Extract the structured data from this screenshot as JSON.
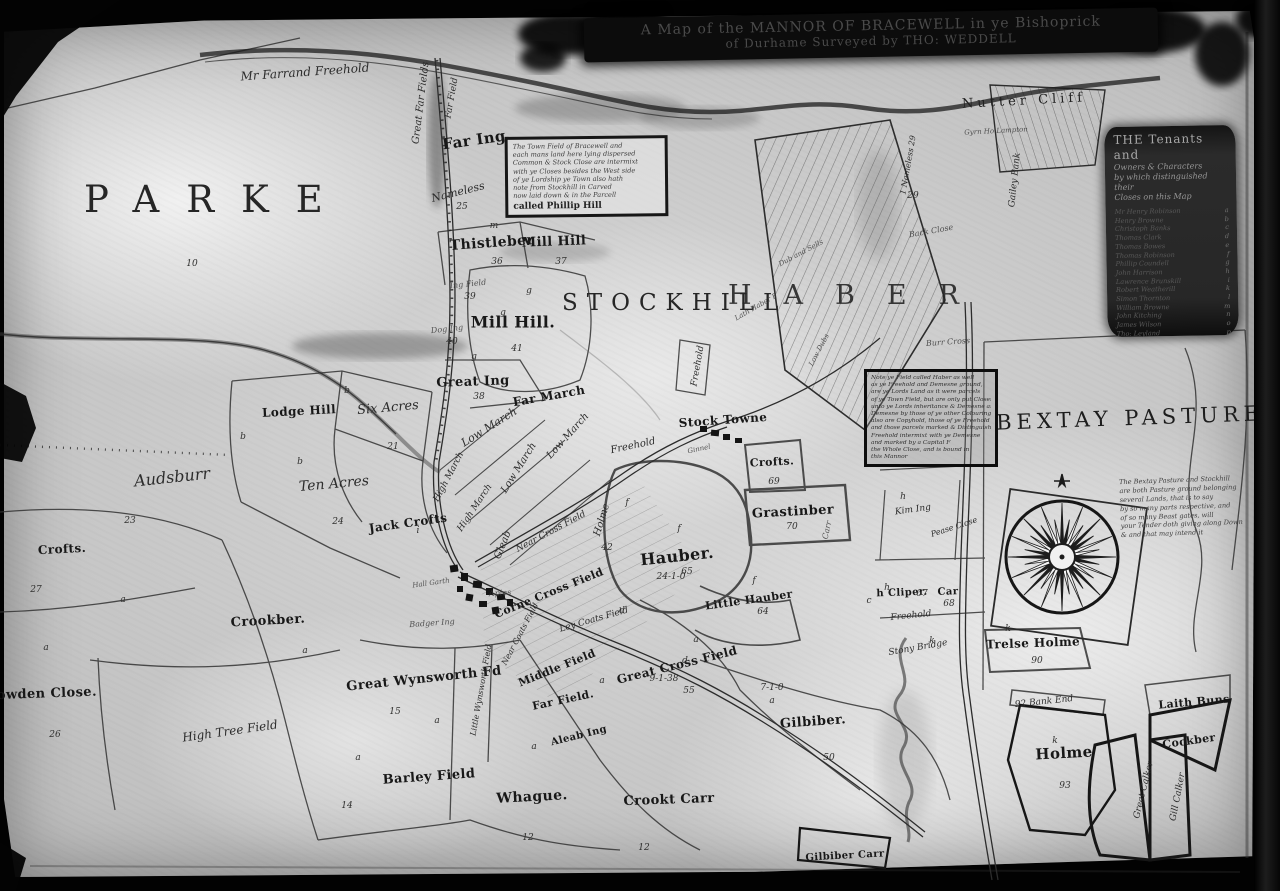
{
  "title": {
    "line1": "A Map of the MANNOR OF BRACEWELL in ye Bishoprick",
    "line2": "of Durhame Surveyed by THO: WEDDELL"
  },
  "regions": {
    "parke": "PARKE",
    "stockhill": "STOCKHILL",
    "haber": "HABER",
    "bextay": "BEXTAY PASTURE"
  },
  "legend": {
    "heading": [
      "THE Tenants and",
      "Owners & Characters",
      "by which distinguished their",
      "Closes on this Map"
    ],
    "tenants": [
      {
        "name": "Mr Henry Robinson",
        "mark": "a"
      },
      {
        "name": "Henry Browne",
        "mark": "b"
      },
      {
        "name": "Christoph Banks",
        "mark": "c"
      },
      {
        "name": "Thomas Clark",
        "mark": "d"
      },
      {
        "name": "Thomas Bowes",
        "mark": "e"
      },
      {
        "name": "Thomas Robinson",
        "mark": "f"
      },
      {
        "name": "Phillip Coundell",
        "mark": "g"
      },
      {
        "name": "John Harrison",
        "mark": "h"
      },
      {
        "name": "Lawrence Brunskill",
        "mark": "i"
      },
      {
        "name": "Robert Weatherill",
        "mark": "k"
      },
      {
        "name": "Simon Thornton",
        "mark": "l"
      },
      {
        "name": "William Browne",
        "mark": "m"
      },
      {
        "name": "John Kitching",
        "mark": "n"
      },
      {
        "name": "James Wilson",
        "mark": "o"
      },
      {
        "name": "Tho: Leyland",
        "mark": "p"
      }
    ]
  },
  "notes": {
    "note_a": {
      "lines": [
        "The Town Field of Bracewell and",
        "each mans land here lying dispersed",
        "Common & Stock Close are intermixt",
        "with ye Closes besides the West side",
        "of ye Lordship ye Town also hath",
        "note from Stockhill in Carved",
        "now laid down & in the Parcell"
      ],
      "last": "called Phillip Hill"
    },
    "note_b": {
      "lines": [
        "Note ye Field called Haber as well",
        "as ye Freehold and Demesne ground,",
        "are ye Lords Land as it were parcels",
        "of ye Town Field, but are only put Closes",
        "unto ye Lords inheritance & Demesne and",
        "Demesne by those of ye other Colourings",
        "also are Copyhold, those of ye Freehold",
        "and those parcels marked & Distinguished",
        "Freehold intermixt with ye Demesne",
        "and marked by a Capital F",
        "the Whole Close, and is bound in",
        "this Mannor"
      ]
    },
    "bextay": {
      "lines": [
        "The Bextay Pasture and Stockhill",
        "are both Pasture ground belonging",
        "several Lands, that is to say",
        "by so many parts respective, and",
        "of so many Beast gates, will",
        "your Tender doth giving along Down",
        "& and that may intend it"
      ]
    }
  },
  "fields": [
    {
      "t": "Mr Farrand Freehold",
      "x": 305,
      "y": 72,
      "r": -4,
      "fs": 12,
      "c": "it"
    },
    {
      "t": "Great Far Fields",
      "x": 421,
      "y": 103,
      "r": -83,
      "fs": 10,
      "c": "it"
    },
    {
      "t": "Far Field",
      "x": 452,
      "y": 98,
      "r": -80,
      "fs": 9,
      "c": "it"
    },
    {
      "t": "Far Ing",
      "x": 474,
      "y": 140,
      "r": -8,
      "fs": 15,
      "c": "bl"
    },
    {
      "t": "Nameless",
      "x": 458,
      "y": 192,
      "r": -14,
      "fs": 11,
      "c": "it"
    },
    {
      "t": "Thistleber",
      "x": 492,
      "y": 243,
      "r": -4,
      "fs": 14,
      "c": "bl"
    },
    {
      "t": "Mill Hill",
      "x": 554,
      "y": 242,
      "r": -2,
      "fs": 13,
      "c": "bl"
    },
    {
      "t": "Ing Field",
      "x": 468,
      "y": 284,
      "r": -6,
      "fs": 8,
      "c": "sm"
    },
    {
      "t": "Mill Hill.",
      "x": 513,
      "y": 322,
      "r": 0,
      "fs": 16,
      "c": "bl"
    },
    {
      "t": "Dog Ing",
      "x": 447,
      "y": 329,
      "r": -6,
      "fs": 8,
      "c": "sm"
    },
    {
      "t": "Great Ing",
      "x": 473,
      "y": 382,
      "r": -2,
      "fs": 13,
      "c": "bl"
    },
    {
      "t": "Far March",
      "x": 549,
      "y": 396,
      "r": -10,
      "fs": 12,
      "c": "bl"
    },
    {
      "t": "Low March",
      "x": 489,
      "y": 427,
      "r": -32,
      "fs": 11,
      "c": "it"
    },
    {
      "t": "Low March",
      "x": 568,
      "y": 436,
      "r": -48,
      "fs": 10,
      "c": "it"
    },
    {
      "t": "Low March",
      "x": 519,
      "y": 468,
      "r": -58,
      "fs": 10,
      "c": "it"
    },
    {
      "t": "High March",
      "x": 449,
      "y": 477,
      "r": -62,
      "fs": 9,
      "c": "it"
    },
    {
      "t": "High March",
      "x": 475,
      "y": 508,
      "r": -56,
      "fs": 9,
      "c": "it"
    },
    {
      "t": "Jack Crofts",
      "x": 408,
      "y": 523,
      "r": -8,
      "fs": 12,
      "c": "bl"
    },
    {
      "t": "Gleab",
      "x": 503,
      "y": 545,
      "r": -68,
      "fs": 10,
      "c": "it"
    },
    {
      "t": "Near Cross Field",
      "x": 551,
      "y": 532,
      "r": -28,
      "fs": 9,
      "c": "it"
    },
    {
      "t": "Holme",
      "x": 602,
      "y": 520,
      "r": -73,
      "fs": 10,
      "c": "it"
    },
    {
      "t": "Corne Cross Field",
      "x": 549,
      "y": 593,
      "r": -22,
      "fs": 11,
      "c": "bl"
    },
    {
      "t": "Ley Coats Field",
      "x": 594,
      "y": 620,
      "r": -16,
      "fs": 9,
      "c": "it"
    },
    {
      "t": "Near Coats Field",
      "x": 520,
      "y": 634,
      "r": -62,
      "fs": 8,
      "c": "it"
    },
    {
      "t": "Hall Garth",
      "x": 431,
      "y": 583,
      "r": -8,
      "fs": 7,
      "c": "sm"
    },
    {
      "t": "Apies",
      "x": 500,
      "y": 593,
      "r": -4,
      "fs": 8,
      "c": "sm"
    },
    {
      "t": "Badger Ing",
      "x": 432,
      "y": 623,
      "r": -4,
      "fs": 8,
      "c": "sm"
    },
    {
      "t": "Great Wynsworth Fd",
      "x": 424,
      "y": 679,
      "r": -6,
      "fs": 13,
      "c": "bl"
    },
    {
      "t": "Little Wynsworth Field",
      "x": 481,
      "y": 690,
      "r": -80,
      "fs": 8,
      "c": "it"
    },
    {
      "t": "Middle Field",
      "x": 557,
      "y": 668,
      "r": -22,
      "fs": 11,
      "c": "bl"
    },
    {
      "t": "Far Field.",
      "x": 563,
      "y": 700,
      "r": -12,
      "fs": 11,
      "c": "bl"
    },
    {
      "t": "Aleab Ing",
      "x": 579,
      "y": 736,
      "r": -14,
      "fs": 10,
      "c": "bl"
    },
    {
      "t": "Great Cross Field",
      "x": 677,
      "y": 665,
      "r": -14,
      "fs": 12,
      "c": "bl"
    },
    {
      "t": "Barley Field",
      "x": 429,
      "y": 777,
      "r": -4,
      "fs": 13,
      "c": "bl"
    },
    {
      "t": "Whague.",
      "x": 532,
      "y": 797,
      "r": -3,
      "fs": 14,
      "c": "bl"
    },
    {
      "t": "Crookt Carr",
      "x": 669,
      "y": 800,
      "r": -2,
      "fs": 13,
      "c": "bl"
    },
    {
      "t": "Gilbiber.",
      "x": 813,
      "y": 722,
      "r": -4,
      "fs": 13,
      "c": "bl"
    },
    {
      "t": "Gilbiber Carr",
      "x": 845,
      "y": 856,
      "r": -3,
      "fs": 10,
      "c": "bl"
    },
    {
      "t": "Lodge Hill",
      "x": 299,
      "y": 411,
      "r": -3,
      "fs": 12,
      "c": "bl"
    },
    {
      "t": "Six Acres",
      "x": 388,
      "y": 408,
      "r": -5,
      "fs": 13,
      "c": "it"
    },
    {
      "t": "Ten Acres",
      "x": 334,
      "y": 484,
      "r": -5,
      "fs": 14,
      "c": "it"
    },
    {
      "t": "Audsburr",
      "x": 172,
      "y": 477,
      "r": -6,
      "fs": 16,
      "c": "it"
    },
    {
      "t": "Crofts.",
      "x": 62,
      "y": 549,
      "r": -3,
      "fs": 12,
      "c": "bl"
    },
    {
      "t": "Crookber.",
      "x": 268,
      "y": 621,
      "r": -3,
      "fs": 13,
      "c": "bl"
    },
    {
      "t": "Sowden Close.",
      "x": 42,
      "y": 694,
      "r": -2,
      "fs": 13,
      "c": "bl"
    },
    {
      "t": "High Tree Field",
      "x": 230,
      "y": 731,
      "r": -8,
      "fs": 12,
      "c": "it"
    },
    {
      "t": "Freehold",
      "x": 698,
      "y": 366,
      "r": -80,
      "fs": 9,
      "c": "it"
    },
    {
      "t": "Stock Towne",
      "x": 723,
      "y": 420,
      "r": -4,
      "fs": 12,
      "c": "bl"
    },
    {
      "t": "Freehold",
      "x": 633,
      "y": 446,
      "r": -12,
      "fs": 10,
      "c": "it"
    },
    {
      "t": "Ginnel",
      "x": 699,
      "y": 449,
      "r": -12,
      "fs": 7,
      "c": "sm"
    },
    {
      "t": "Hauber.",
      "x": 677,
      "y": 556,
      "r": -6,
      "fs": 16,
      "c": "bl"
    },
    {
      "t": "Little Hauber",
      "x": 749,
      "y": 600,
      "r": -8,
      "fs": 11,
      "c": "bl"
    },
    {
      "t": "Crofts.",
      "x": 772,
      "y": 462,
      "r": -3,
      "fs": 11,
      "c": "bl"
    },
    {
      "t": "Grastinber",
      "x": 793,
      "y": 512,
      "r": -3,
      "fs": 13,
      "c": "bl"
    },
    {
      "t": "Carr",
      "x": 827,
      "y": 530,
      "r": -78,
      "fs": 8,
      "c": "sm"
    },
    {
      "t": "Kim Ing",
      "x": 913,
      "y": 510,
      "r": -8,
      "fs": 9,
      "c": "it"
    },
    {
      "t": "Pease Close",
      "x": 954,
      "y": 527,
      "r": -18,
      "fs": 8,
      "c": "it"
    },
    {
      "t": "h Cliper.",
      "x": 902,
      "y": 593,
      "r": -2,
      "fs": 10,
      "c": "bl"
    },
    {
      "t": "Car",
      "x": 948,
      "y": 592,
      "r": -2,
      "fs": 10,
      "c": "bl"
    },
    {
      "t": "Freehold",
      "x": 911,
      "y": 616,
      "r": -6,
      "fs": 9,
      "c": "it"
    },
    {
      "t": "Stony Bridge",
      "x": 918,
      "y": 648,
      "r": -10,
      "fs": 9,
      "c": "it"
    },
    {
      "t": "Trelse Holme",
      "x": 1033,
      "y": 643,
      "r": -2,
      "fs": 12,
      "c": "bl"
    },
    {
      "t": "92 Bank End",
      "x": 1044,
      "y": 702,
      "r": -6,
      "fs": 9,
      "c": "it"
    },
    {
      "t": "Holme",
      "x": 1064,
      "y": 753,
      "r": -3,
      "fs": 15,
      "c": "bl"
    },
    {
      "t": "Laith Buns",
      "x": 1194,
      "y": 702,
      "r": -5,
      "fs": 11,
      "c": "bl"
    },
    {
      "t": "Cockber",
      "x": 1189,
      "y": 741,
      "r": -8,
      "fs": 11,
      "c": "bl"
    },
    {
      "t": "Great Calker",
      "x": 1144,
      "y": 790,
      "r": -76,
      "fs": 9,
      "c": "it"
    },
    {
      "t": "Gill Calker",
      "x": 1178,
      "y": 797,
      "r": -79,
      "fs": 9,
      "c": "it"
    },
    {
      "t": "Nutter Cliff",
      "x": 1024,
      "y": 101,
      "r": -3,
      "fs": 13,
      "c": "sc"
    },
    {
      "t": "Gyrn Ho Lampton",
      "x": 996,
      "y": 131,
      "r": -3,
      "fs": 7,
      "c": "sm"
    },
    {
      "t": "Gailey Bank",
      "x": 1015,
      "y": 180,
      "r": -84,
      "fs": 9,
      "c": "it"
    },
    {
      "t": "1 Nameless 29",
      "x": 908,
      "y": 165,
      "r": -80,
      "fs": 8,
      "c": "it"
    },
    {
      "t": "Back Close",
      "x": 931,
      "y": 231,
      "r": -10,
      "fs": 8,
      "c": "sm"
    },
    {
      "t": "Dub and Sells",
      "x": 801,
      "y": 253,
      "r": -28,
      "fs": 7,
      "c": "sm"
    },
    {
      "t": "Lath Haber F",
      "x": 756,
      "y": 307,
      "r": -30,
      "fs": 7,
      "c": "sm"
    },
    {
      "t": "Low Dubs",
      "x": 819,
      "y": 350,
      "r": -62,
      "fs": 7,
      "c": "sm"
    },
    {
      "t": "Burr Cross",
      "x": 948,
      "y": 342,
      "r": -4,
      "fs": 8,
      "c": "sm"
    }
  ],
  "marks": [
    {
      "t": "10",
      "x": 192,
      "y": 264
    },
    {
      "t": "23",
      "x": 130,
      "y": 521
    },
    {
      "t": "21",
      "x": 393,
      "y": 447
    },
    {
      "t": "24",
      "x": 338,
      "y": 522
    },
    {
      "t": "27",
      "x": 36,
      "y": 590
    },
    {
      "t": "26",
      "x": 55,
      "y": 735
    },
    {
      "t": "15",
      "x": 395,
      "y": 712
    },
    {
      "t": "14",
      "x": 347,
      "y": 806
    },
    {
      "t": "12",
      "x": 528,
      "y": 838
    },
    {
      "t": "12",
      "x": 644,
      "y": 848
    },
    {
      "t": "55",
      "x": 689,
      "y": 691
    },
    {
      "t": "9-1-38",
      "x": 664,
      "y": 679
    },
    {
      "t": "50",
      "x": 829,
      "y": 758
    },
    {
      "t": "36",
      "x": 497,
      "y": 262
    },
    {
      "t": "37",
      "x": 561,
      "y": 262
    },
    {
      "t": "41",
      "x": 517,
      "y": 349
    },
    {
      "t": "39",
      "x": 470,
      "y": 297
    },
    {
      "t": "40",
      "x": 452,
      "y": 342
    },
    {
      "t": "38",
      "x": 479,
      "y": 397
    },
    {
      "t": "25",
      "x": 462,
      "y": 207
    },
    {
      "t": "29",
      "x": 913,
      "y": 196
    },
    {
      "t": "65",
      "x": 687,
      "y": 572
    },
    {
      "t": "24-1-0",
      "x": 671,
      "y": 577
    },
    {
      "t": "64",
      "x": 763,
      "y": 612
    },
    {
      "t": "69",
      "x": 774,
      "y": 482
    },
    {
      "t": "70",
      "x": 792,
      "y": 527
    },
    {
      "t": "67",
      "x": 922,
      "y": 594
    },
    {
      "t": "68",
      "x": 949,
      "y": 604
    },
    {
      "t": "90",
      "x": 1037,
      "y": 661
    },
    {
      "t": "93",
      "x": 1065,
      "y": 786
    },
    {
      "t": "42",
      "x": 607,
      "y": 548
    },
    {
      "t": "7-1-0",
      "x": 772,
      "y": 688
    },
    {
      "t": "b",
      "x": 347,
      "y": 391
    },
    {
      "t": "b",
      "x": 243,
      "y": 437
    },
    {
      "t": "b",
      "x": 300,
      "y": 462
    },
    {
      "t": "g",
      "x": 529,
      "y": 291
    },
    {
      "t": "g",
      "x": 503,
      "y": 313
    },
    {
      "t": "g",
      "x": 474,
      "y": 357
    },
    {
      "t": "m",
      "x": 494,
      "y": 226
    },
    {
      "t": "f",
      "x": 679,
      "y": 529
    },
    {
      "t": "f",
      "x": 754,
      "y": 581
    },
    {
      "t": "f",
      "x": 627,
      "y": 503
    },
    {
      "t": "a",
      "x": 46,
      "y": 648
    },
    {
      "t": "a",
      "x": 123,
      "y": 600
    },
    {
      "t": "a",
      "x": 305,
      "y": 651
    },
    {
      "t": "a",
      "x": 437,
      "y": 721
    },
    {
      "t": "a",
      "x": 534,
      "y": 747
    },
    {
      "t": "a",
      "x": 602,
      "y": 681
    },
    {
      "t": "a",
      "x": 696,
      "y": 640
    },
    {
      "t": "a",
      "x": 772,
      "y": 701
    },
    {
      "t": "a",
      "x": 358,
      "y": 758
    },
    {
      "t": "h",
      "x": 903,
      "y": 497
    },
    {
      "t": "h",
      "x": 887,
      "y": 588
    },
    {
      "t": "k",
      "x": 1008,
      "y": 629
    },
    {
      "t": "k",
      "x": 932,
      "y": 641
    },
    {
      "t": "k",
      "x": 1055,
      "y": 741
    },
    {
      "t": "i",
      "x": 418,
      "y": 531
    },
    {
      "t": "d",
      "x": 622,
      "y": 611
    },
    {
      "t": "d",
      "x": 685,
      "y": 661
    },
    {
      "t": "c",
      "x": 869,
      "y": 601
    }
  ],
  "compass": {
    "north_star": "✦"
  }
}
